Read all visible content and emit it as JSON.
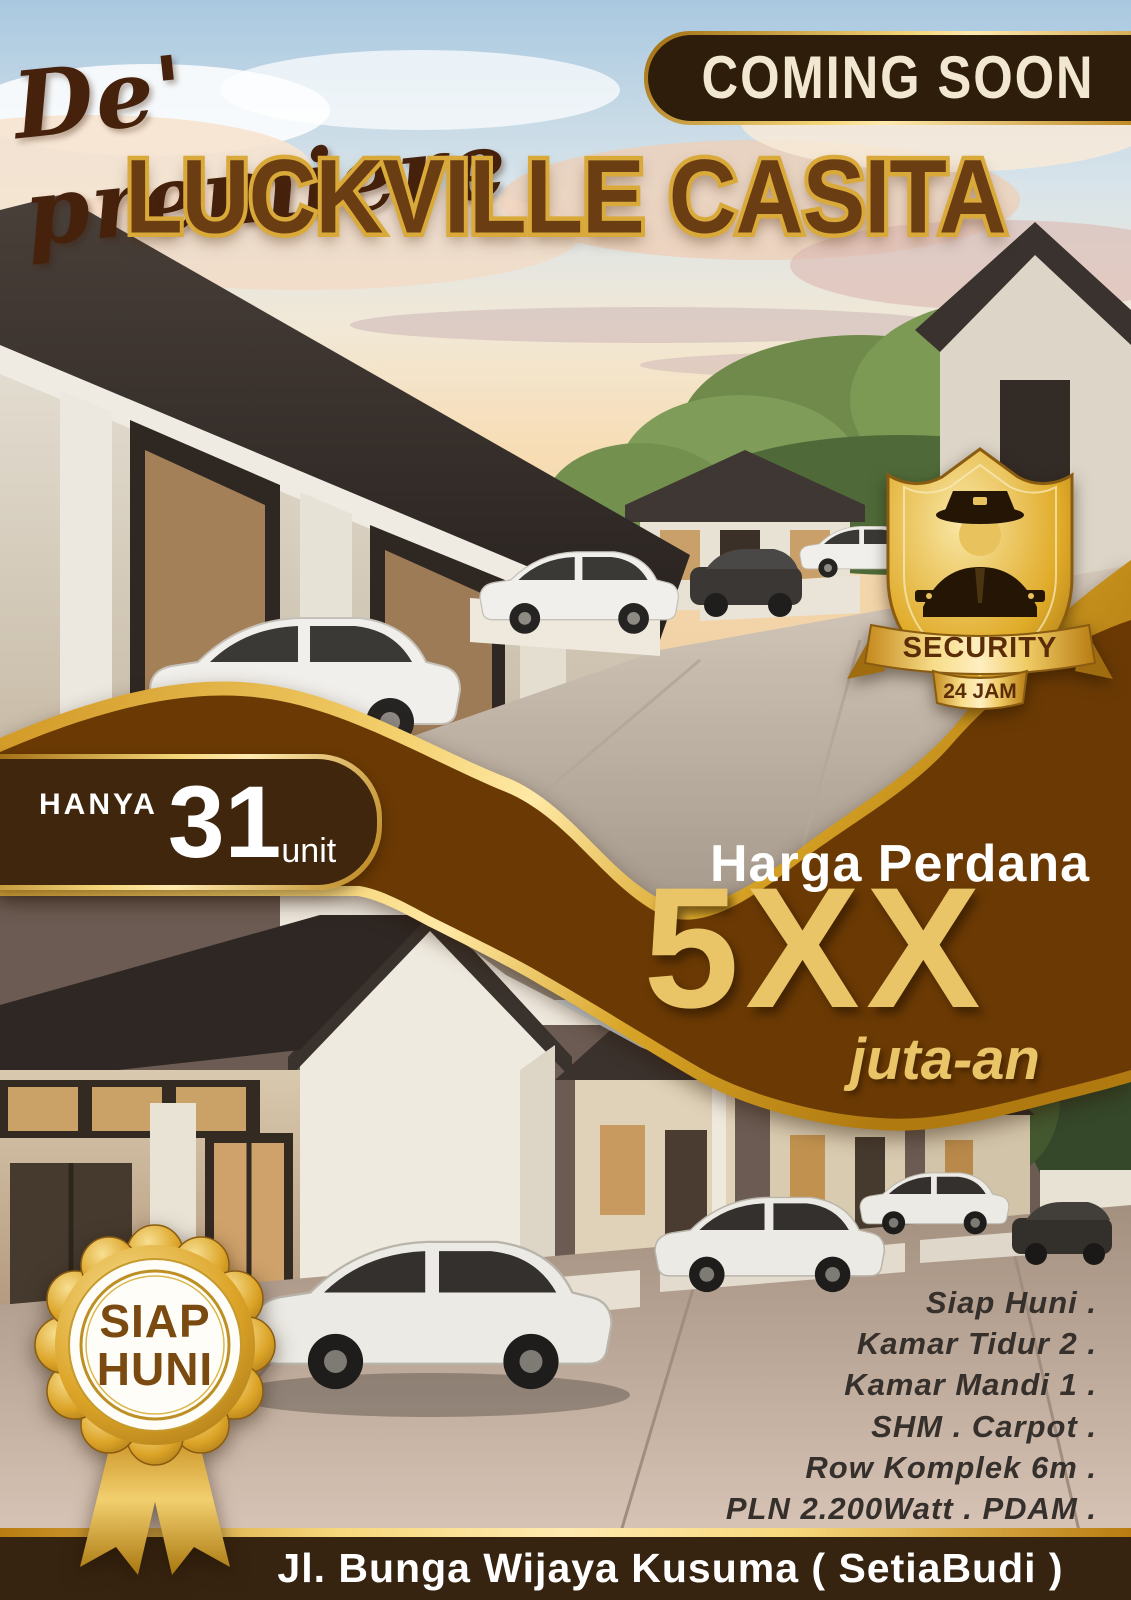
{
  "poster": {
    "brand_script": "De' premiere",
    "coming_soon_label": "COMING SOON",
    "title": "LUCKVILLE CASITA",
    "security_badge": {
      "icon": "security-guard-icon",
      "line1": "SECURITY",
      "line2": "24 JAM"
    },
    "units_banner": {
      "prefix": "HANYA",
      "count": "31",
      "suffix": "unit"
    },
    "price": {
      "label": "Harga Perdana",
      "value": "5XX",
      "unit": "juta-an"
    },
    "ready_badge": {
      "word1": "SIAP",
      "word2": "HUNI"
    },
    "features": [
      "Siap Huni .",
      "Kamar Tidur 2 .",
      "Kamar Mandi 1 .",
      "SHM . Carpot .",
      "Row Komplek 6m .",
      "PLN 2.200Watt . PDAM ."
    ],
    "address": "Jl. Bunga Wijaya Kusuma ( SetiaBudi )",
    "colors": {
      "wave_brown": "#6b3a04",
      "pill_brown": "#40260d",
      "badge_brown": "#2f1d0b",
      "bar_brown": "#362310",
      "gold": "#e0ab28",
      "gold_light": "#ffeab0",
      "price_gold": "#e9c568",
      "cream_text": "#f2e7d0",
      "title_brown": "#6b3d12",
      "title_outline_gold": "#d9a93a"
    }
  }
}
